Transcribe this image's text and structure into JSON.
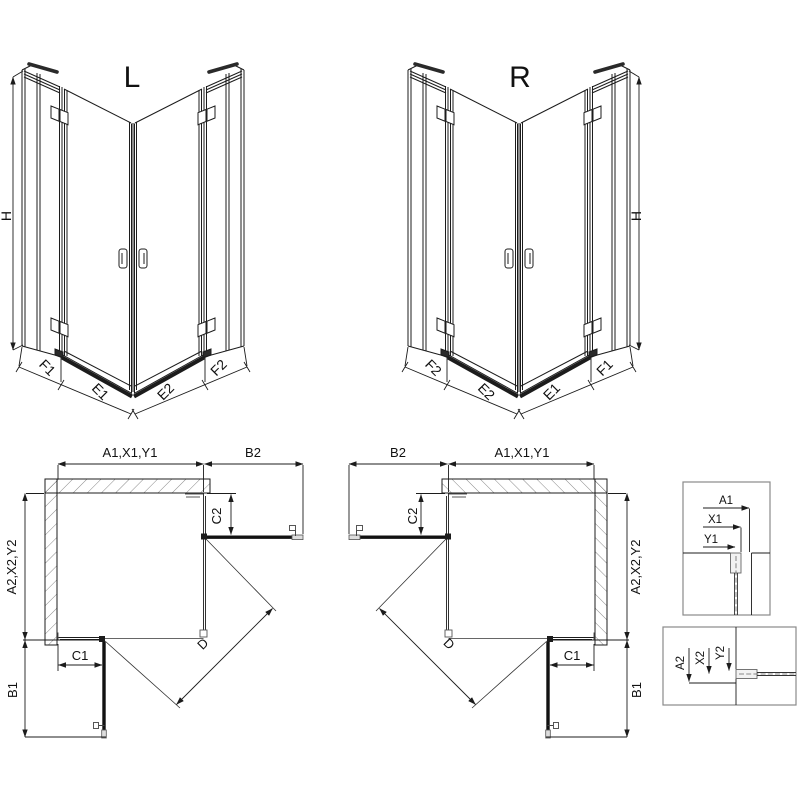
{
  "page": {
    "background": "#ffffff"
  },
  "colors": {
    "line": "#1c1c1c",
    "dim_text": "#111111",
    "profile_gray": "#8a8a8a",
    "dark_bar": "#111111",
    "hatch": "#555555"
  },
  "views": {
    "iso_left": {
      "title": "L",
      "height_label": "H",
      "segments": {
        "f1": "F1",
        "e1": "E1",
        "e2": "E2",
        "f2": "F2"
      }
    },
    "iso_right": {
      "title": "R",
      "height_label": "H",
      "segments": {
        "f2": "F2",
        "e2": "E2",
        "e1": "E1",
        "f1": "F1"
      }
    },
    "plan_left": {
      "width_group": "A1,X1,Y1",
      "door_reach_top": "B2",
      "fixed_right": "C2",
      "depth_group": "A2,X2,Y2",
      "fixed_bottom": "C1",
      "door_reach_side": "B1",
      "diagonal": "D"
    },
    "plan_right": {
      "width_group": "A1,X1,Y1",
      "door_reach_top": "B2",
      "fixed_right": "C2",
      "depth_group": "A2,X2,Y2",
      "fixed_bottom": "C1",
      "door_reach_side": "B1",
      "diagonal": "D"
    },
    "detail_top": {
      "a1": "A1",
      "x1": "X1",
      "y1": "Y1"
    },
    "detail_bottom": {
      "a2": "A2",
      "x2": "X2",
      "y2": "Y2"
    }
  }
}
